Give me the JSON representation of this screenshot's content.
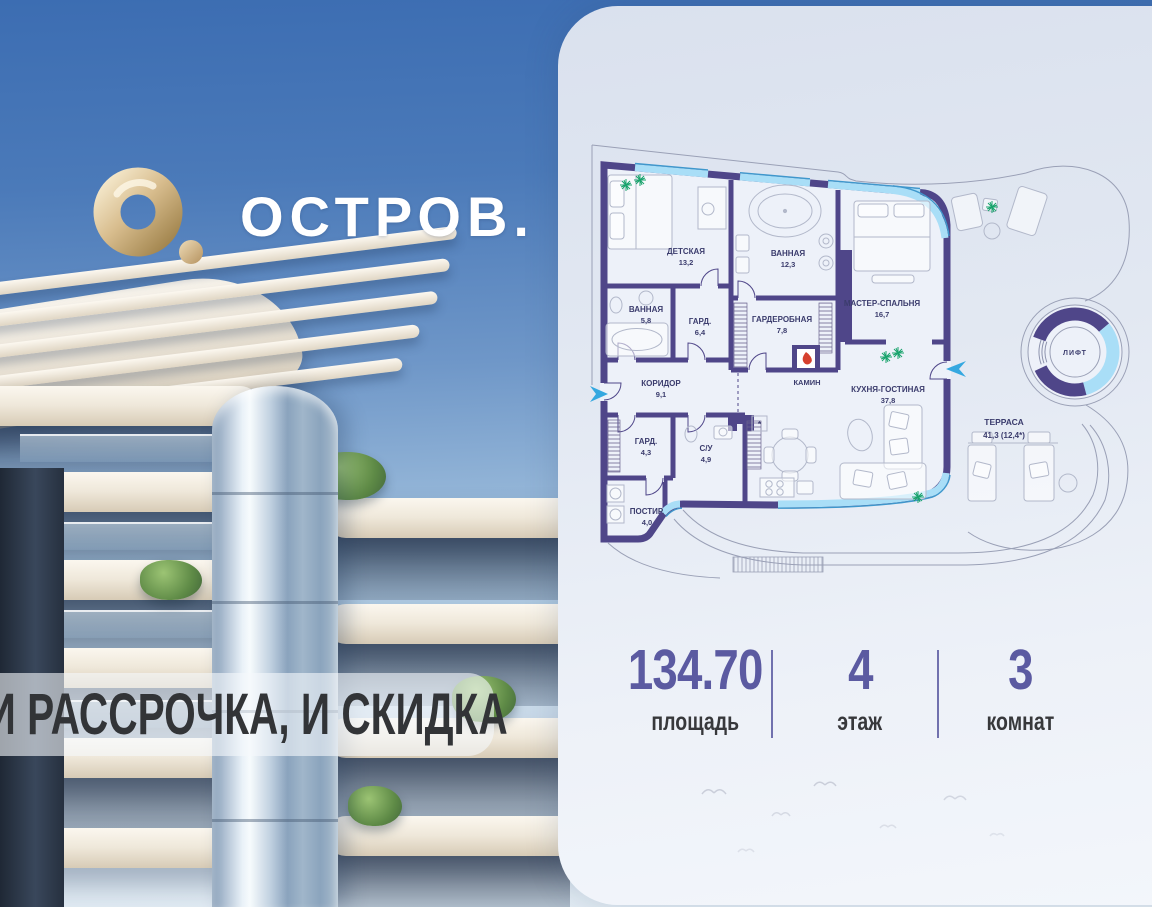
{
  "brand": {
    "logo_text": "ОСТРОВ."
  },
  "promo": {
    "banner_text": "И РАССРОЧКА, И СКИДКА"
  },
  "plan": {
    "rooms": {
      "nursery": {
        "name": "ДЕТСКАЯ",
        "area": "13,2"
      },
      "bathroom_main": {
        "name": "ВАННАЯ",
        "area": "12,3"
      },
      "master": {
        "name": "МАСТЕР-СПАЛЬНЯ",
        "area": "16,7"
      },
      "bathroom_small": {
        "name": "ВАННАЯ",
        "area": "5,8"
      },
      "wardrobe_64": {
        "name": "ГАРД.",
        "area": "6,4"
      },
      "dressing": {
        "name": "ГАРДЕРОБНАЯ",
        "area": "7,8"
      },
      "corridor": {
        "name": "КОРИДОР",
        "area": "9,1"
      },
      "fireplace": {
        "name": "КАМИН"
      },
      "kitchen_living": {
        "name": "КУХНЯ-ГОСТИНАЯ",
        "area": "37,8"
      },
      "wardrobe_43": {
        "name": "ГАРД.",
        "area": "4,3"
      },
      "wc": {
        "name": "С/У",
        "area": "4,9"
      },
      "laundry": {
        "name": "ПОСТИР.",
        "area": "4,0"
      },
      "terrace": {
        "name": "ТЕРРАСА",
        "area": "41,3 (12,4*)"
      },
      "lift": {
        "name": "ЛИФТ"
      }
    }
  },
  "stats": {
    "items": [
      {
        "value": "134.70",
        "label": "площадь"
      },
      {
        "value": "4",
        "label": "этаж"
      },
      {
        "value": "3",
        "label": "комнат"
      }
    ]
  },
  "colors": {
    "wall": "#4f4689",
    "window": "#a9def7",
    "window_edge": "#3f97cc",
    "stats_accent": "#5b5aa1",
    "entry_arrow": "#35a8e0",
    "flame": "#d6402e",
    "plant": "#18a36c",
    "logo_gold": "#c9ab79",
    "sky_top": "#3c6db2"
  }
}
